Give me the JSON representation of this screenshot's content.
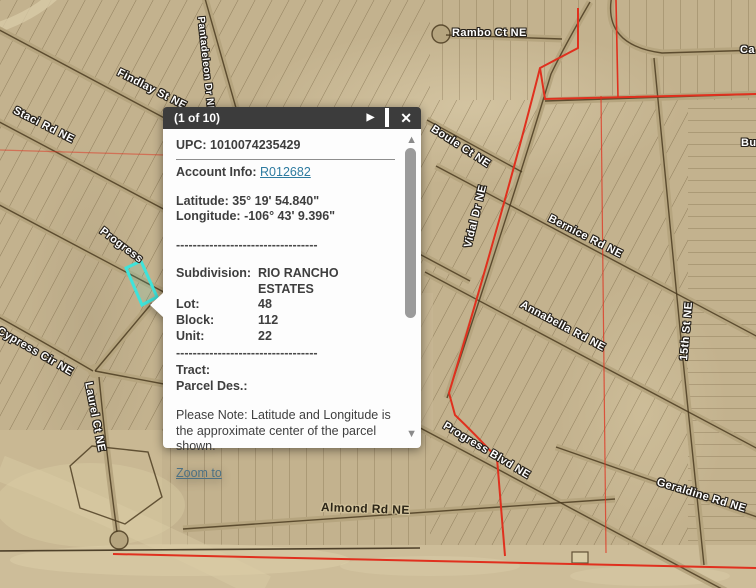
{
  "popup": {
    "title": "(1 of 10)",
    "icons": {
      "next_glyph": "▶",
      "close_glyph": "✕",
      "maximize_name": "maximize-icon"
    },
    "scrollbar": {
      "up_glyph": "▲",
      "down_glyph": "▼"
    },
    "upc_label": "UPC:",
    "upc_value": "1010074235429",
    "account_label": "Account Info:",
    "account_link": "R012682",
    "latitude_label": "Latitude:",
    "latitude_value": "35° 19' 54.840\"",
    "longitude_label": "Longitude:",
    "longitude_value": "-106° 43' 9.396\"",
    "divider_dashes": "----------------------------------",
    "subdivision_label": "Subdivision:",
    "subdivision_value": "RIO RANCHO ESTATES",
    "lot_label": "Lot:",
    "lot_value": "48",
    "block_label": "Block:",
    "block_value": "112",
    "unit_label": "Unit:",
    "unit_value": "22",
    "tract_label": "Tract:",
    "parcel_des_label": "Parcel Des.:",
    "note_text": "Please Note: Latitude and Longitude is the approximate center of the parcel shown.",
    "zoom_to_label": "Zoom to"
  },
  "map": {
    "street_labels": [
      {
        "id": "findlay",
        "text": "Findlay St NE"
      },
      {
        "id": "pantadeleon",
        "text": "Pantadeleon Dr NE"
      },
      {
        "id": "staci",
        "text": "Staci Rd NE"
      },
      {
        "id": "rambo",
        "text": "Rambo Ct NE"
      },
      {
        "id": "ca-partial",
        "text": "Ca"
      },
      {
        "id": "boule",
        "text": "Boule Ct NE"
      },
      {
        "id": "vidal",
        "text": "Vidal Dr NE"
      },
      {
        "id": "bu-partial",
        "text": "Bu"
      },
      {
        "id": "bernice",
        "text": "Bernice Rd NE"
      },
      {
        "id": "annabella",
        "text": "Annabella Rd NE"
      },
      {
        "id": "fifteenth",
        "text": "15th St NE"
      },
      {
        "id": "progress",
        "text": "Progress"
      },
      {
        "id": "cypress",
        "text": "Cypress Cir NE"
      },
      {
        "id": "laurel",
        "text": "Laurel Ct NE"
      },
      {
        "id": "progress-blvd",
        "text": "Progress Blvd NE"
      },
      {
        "id": "geraldine",
        "text": "Geraldine Rd NE"
      },
      {
        "id": "almond",
        "text": "Almond Rd NE"
      }
    ],
    "colors": {
      "selected_parcel": "#3fe3da",
      "boundary_overlay": "#e0301e",
      "terrain_base": "#c3b28e"
    }
  }
}
